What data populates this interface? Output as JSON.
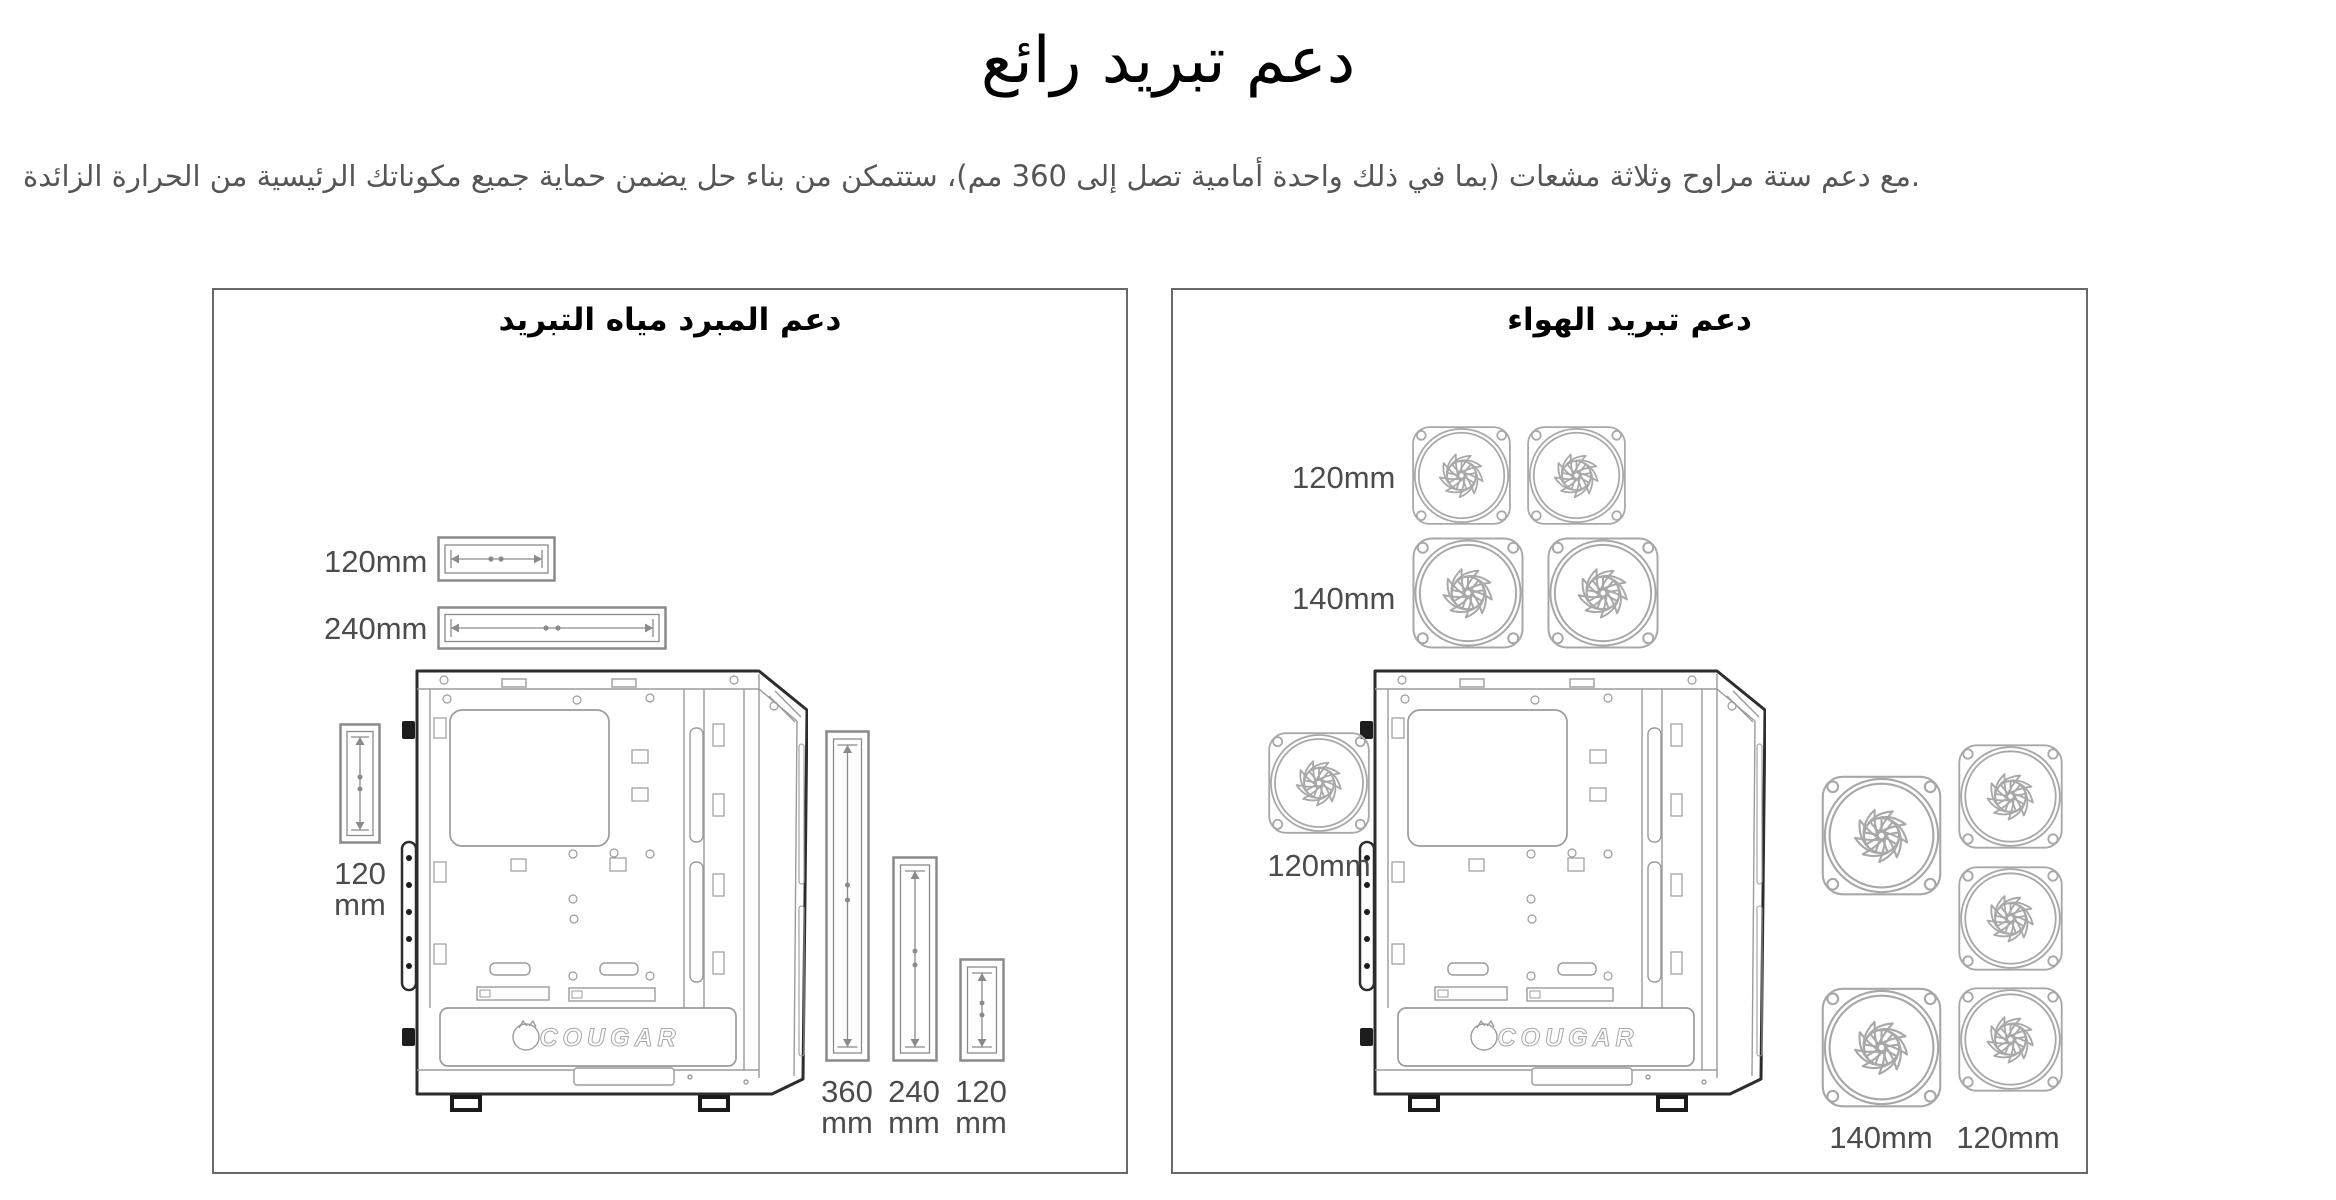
{
  "page": {
    "title": "دعم تبريد رائع",
    "subtitle": "مع دعم ستة مراوح وثلاثة مشعات (بما في ذلك واحدة أمامية تصل إلى 360 مم)، ستتمكن من بناء حل يضمن حماية جميع مكوناتك الرئيسية من الحرارة الزائدة."
  },
  "brand_logo": "COUGAR",
  "liquid_panel": {
    "title": "دعم المبرد مياه التبريد",
    "top_radiator_labels": [
      "120mm",
      "240mm"
    ],
    "rear_radiator_label": {
      "size": "120",
      "unit": "mm"
    },
    "front_radiator_labels": [
      {
        "size": "360",
        "unit": "mm"
      },
      {
        "size": "240",
        "unit": "mm"
      },
      {
        "size": "120",
        "unit": "mm"
      }
    ]
  },
  "air_panel": {
    "title": "دعم تبريد الهواء",
    "top_fan_labels": [
      "120mm",
      "140mm"
    ],
    "rear_fan_label": "120mm",
    "front_fan_labels": [
      "140mm",
      "120mm"
    ]
  },
  "colors": {
    "panel_border": "#696969",
    "label_text": "#4c4c4c",
    "heading_text": "#000000",
    "subtitle_text": "#555555",
    "line_art": "#9b9b9b",
    "line_art_dark": "#2d2d2d",
    "fan_line": "#a8a8a8",
    "radiator_line": "#8a8a8a"
  }
}
